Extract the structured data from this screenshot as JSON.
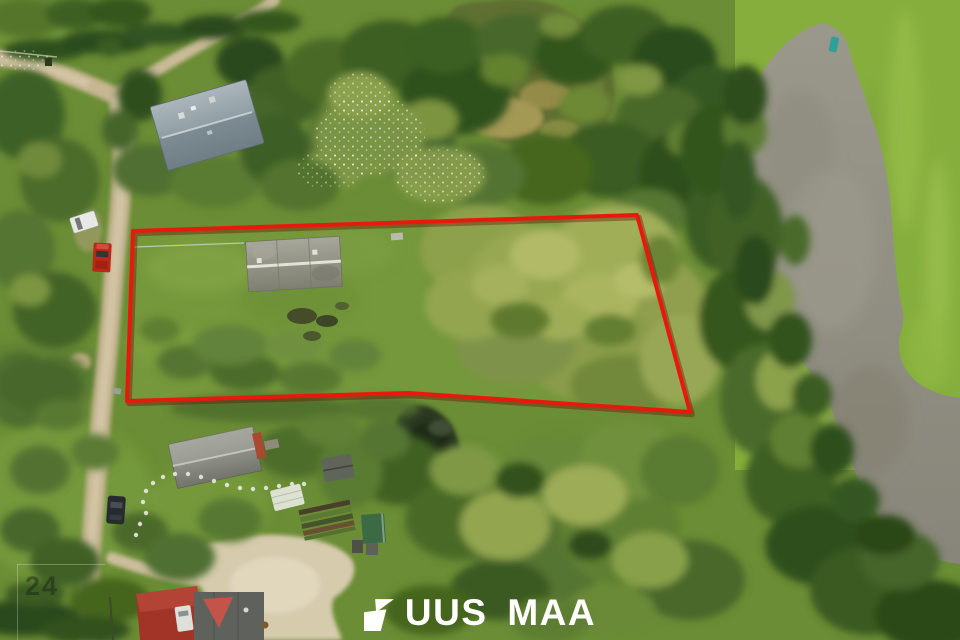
{
  "brand": {
    "logo_text": "UUS MAA",
    "logo_mark_icon": "uus-maa-flag-logo-icon",
    "logo_color": "#ffffff"
  },
  "watermark": {
    "number": "24"
  },
  "property_boundary": {
    "points": "133,231 637,215 690,412 408,393 127,401",
    "color": "#e8190c"
  },
  "colors": {
    "boundary_red": "#e8190c",
    "pond_water_gray": "#93917f",
    "dirt_road_tan": "#c6b692",
    "gravel_light": "#d6cbad",
    "lawn_green": "#76993c",
    "forest_dark_green": "#33541e",
    "willow_pale_green": "#97a851",
    "roof_gray_blue": "#8b9aa2",
    "roof_gray": "#91927f",
    "red_car": "#bb2718",
    "logo_white": "#ffffff"
  }
}
